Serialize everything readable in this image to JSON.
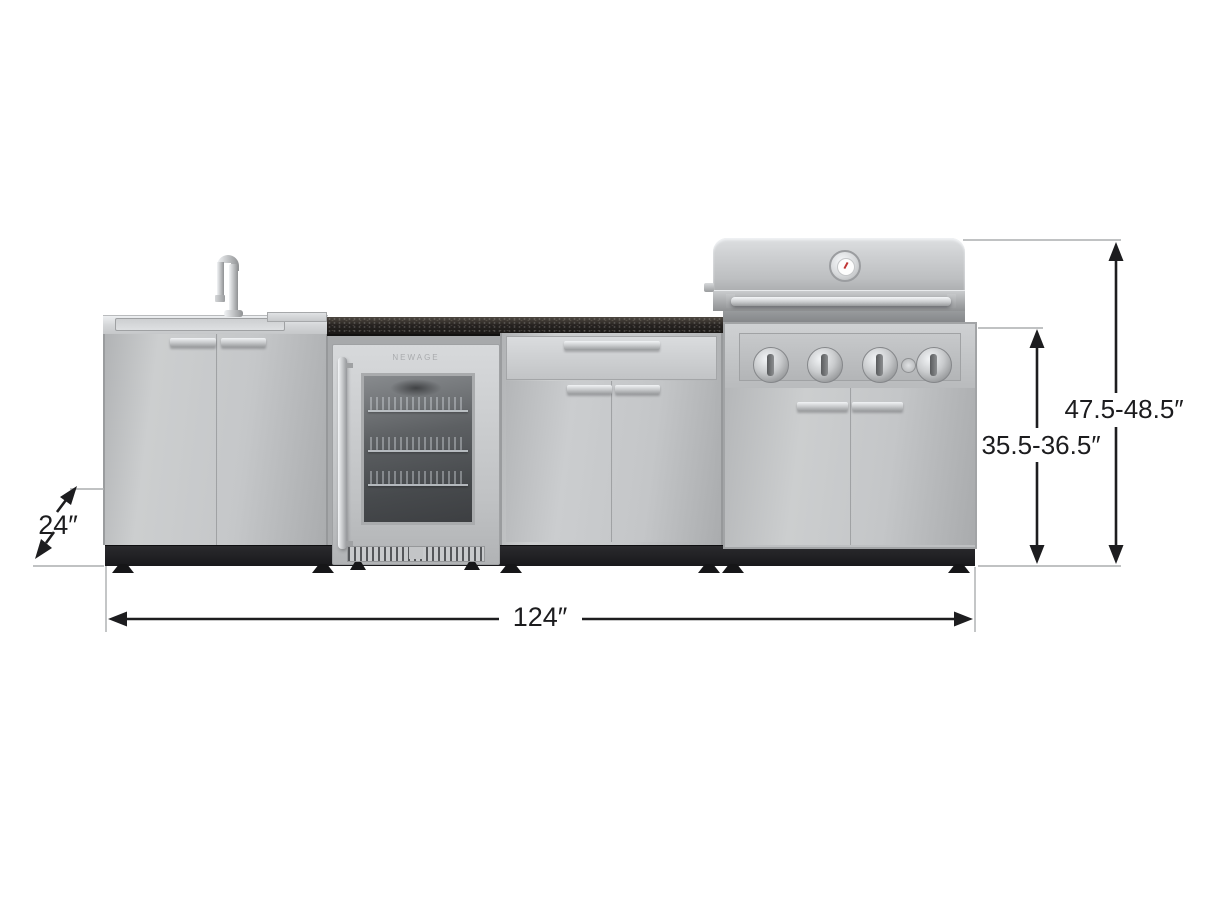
{
  "diagram": {
    "brand_logo": "NEWAGE",
    "dimensions": {
      "depth": "24″",
      "width": "124″",
      "counter_height": "35.5-36.5″",
      "overall_height": "47.5-48.5″"
    },
    "colors": {
      "dimension_line": "#1d1d1f",
      "extension_line": "#abadaf",
      "stainless": "#c6c8ca",
      "granite_counter": "#2b2826",
      "base_black": "#1f1f22",
      "background": "#ffffff"
    }
  }
}
